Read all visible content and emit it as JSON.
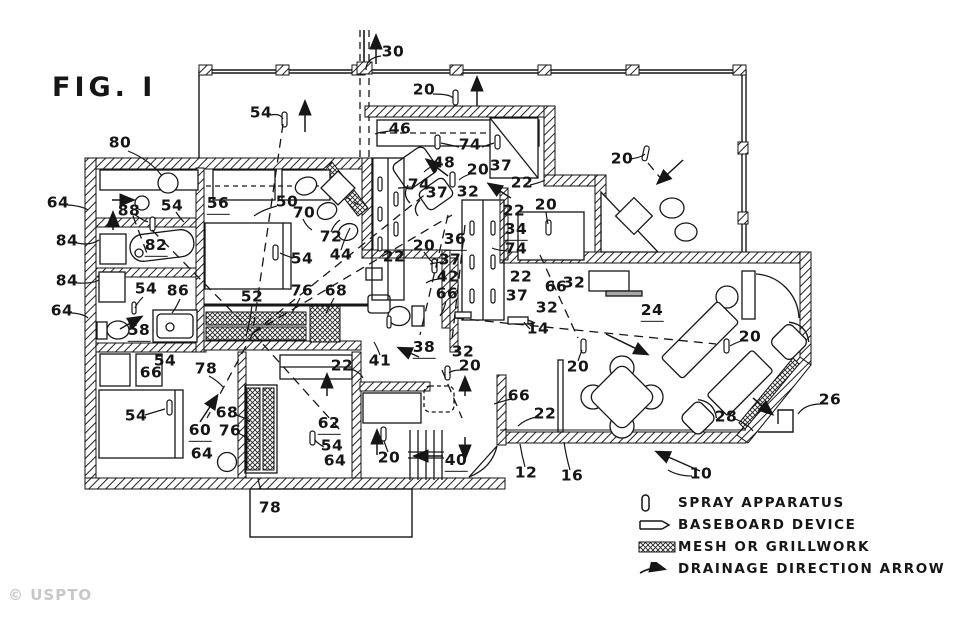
{
  "figure": {
    "title": "FIG. I"
  },
  "watermark": "© USPTO",
  "legend": {
    "items": [
      {
        "label": "SPRAY APPARATUS",
        "icon": "spray-apparatus-icon"
      },
      {
        "label": "BASEBOARD DEVICE",
        "icon": "baseboard-device-icon"
      },
      {
        "label": "MESH OR GRILLWORK",
        "icon": "mesh-grillwork-icon"
      },
      {
        "label": "DRAINAGE DIRECTION ARROW",
        "icon": "drainage-arrow-icon"
      }
    ]
  },
  "plan_labels": [
    {
      "t": "30",
      "x": 393,
      "y": 53
    },
    {
      "t": "54",
      "x": 261,
      "y": 114
    },
    {
      "t": "20",
      "x": 424,
      "y": 91
    },
    {
      "t": "20",
      "x": 622,
      "y": 160
    },
    {
      "t": "80",
      "x": 120,
      "y": 144
    },
    {
      "t": "46",
      "x": 400,
      "y": 130
    },
    {
      "t": "74",
      "x": 470,
      "y": 146
    },
    {
      "t": "48",
      "x": 444,
      "y": 164
    },
    {
      "t": "20",
      "x": 478,
      "y": 171
    },
    {
      "t": "37",
      "x": 501,
      "y": 167
    },
    {
      "t": "22",
      "x": 522,
      "y": 184
    },
    {
      "t": "74",
      "x": 419,
      "y": 186
    },
    {
      "t": "37",
      "x": 437,
      "y": 194
    },
    {
      "t": "32",
      "x": 468,
      "y": 193
    },
    {
      "t": "22",
      "x": 514,
      "y": 212
    },
    {
      "t": "20",
      "x": 546,
      "y": 206
    },
    {
      "t": "64",
      "x": 58,
      "y": 204
    },
    {
      "t": "88",
      "x": 129,
      "y": 212
    },
    {
      "t": "54",
      "x": 172,
      "y": 207
    },
    {
      "t": "56",
      "x": 218,
      "y": 206,
      "u": 1
    },
    {
      "t": "50",
      "x": 287,
      "y": 203
    },
    {
      "t": "70",
      "x": 304,
      "y": 214
    },
    {
      "t": "72",
      "x": 331,
      "y": 238
    },
    {
      "t": "44",
      "x": 341,
      "y": 256
    },
    {
      "t": "84",
      "x": 67,
      "y": 242
    },
    {
      "t": "82",
      "x": 156,
      "y": 248,
      "u": 1
    },
    {
      "t": "54",
      "x": 302,
      "y": 260
    },
    {
      "t": "22",
      "x": 394,
      "y": 258
    },
    {
      "t": "20",
      "x": 424,
      "y": 247
    },
    {
      "t": "36",
      "x": 455,
      "y": 242,
      "u": 1
    },
    {
      "t": "34",
      "x": 516,
      "y": 232,
      "u": 1
    },
    {
      "t": "74",
      "x": 516,
      "y": 250
    },
    {
      "t": "37",
      "x": 450,
      "y": 261
    },
    {
      "t": "42",
      "x": 448,
      "y": 278
    },
    {
      "t": "66",
      "x": 447,
      "y": 295
    },
    {
      "t": "22",
      "x": 521,
      "y": 278
    },
    {
      "t": "37",
      "x": 517,
      "y": 297
    },
    {
      "t": "66",
      "x": 556,
      "y": 288
    },
    {
      "t": "32",
      "x": 574,
      "y": 284
    },
    {
      "t": "84",
      "x": 67,
      "y": 282
    },
    {
      "t": "54",
      "x": 146,
      "y": 290
    },
    {
      "t": "86",
      "x": 178,
      "y": 292
    },
    {
      "t": "64",
      "x": 62,
      "y": 312
    },
    {
      "t": "52",
      "x": 252,
      "y": 298
    },
    {
      "t": "76",
      "x": 302,
      "y": 292
    },
    {
      "t": "68",
      "x": 336,
      "y": 292
    },
    {
      "t": "24",
      "x": 652,
      "y": 313,
      "u": 1
    },
    {
      "t": "20",
      "x": 750,
      "y": 338
    },
    {
      "t": "58",
      "x": 139,
      "y": 333,
      "u": 1
    },
    {
      "t": "54",
      "x": 165,
      "y": 362
    },
    {
      "t": "66",
      "x": 151,
      "y": 374
    },
    {
      "t": "78",
      "x": 206,
      "y": 370
    },
    {
      "t": "32",
      "x": 547,
      "y": 309
    },
    {
      "t": "14",
      "x": 538,
      "y": 330
    },
    {
      "t": "41",
      "x": 380,
      "y": 362
    },
    {
      "t": "38",
      "x": 424,
      "y": 350,
      "u": 1
    },
    {
      "t": "32",
      "x": 463,
      "y": 353
    },
    {
      "t": "20",
      "x": 470,
      "y": 367
    },
    {
      "t": "22",
      "x": 342,
      "y": 367
    },
    {
      "t": "20",
      "x": 578,
      "y": 368
    },
    {
      "t": "66",
      "x": 519,
      "y": 397
    },
    {
      "t": "22",
      "x": 545,
      "y": 415
    },
    {
      "t": "54",
      "x": 136,
      "y": 417
    },
    {
      "t": "68",
      "x": 227,
      "y": 414
    },
    {
      "t": "60",
      "x": 200,
      "y": 433,
      "u": 1
    },
    {
      "t": "76",
      "x": 230,
      "y": 432
    },
    {
      "t": "64",
      "x": 202,
      "y": 455
    },
    {
      "t": "62",
      "x": 329,
      "y": 426,
      "u": 1
    },
    {
      "t": "54",
      "x": 332,
      "y": 447
    },
    {
      "t": "64",
      "x": 335,
      "y": 462
    },
    {
      "t": "20",
      "x": 389,
      "y": 459
    },
    {
      "t": "40",
      "x": 456,
      "y": 463,
      "u": 1
    },
    {
      "t": "12",
      "x": 526,
      "y": 474
    },
    {
      "t": "16",
      "x": 572,
      "y": 477
    },
    {
      "t": "10",
      "x": 701,
      "y": 475
    },
    {
      "t": "28",
      "x": 726,
      "y": 418
    },
    {
      "t": "26",
      "x": 830,
      "y": 401
    },
    {
      "t": "78",
      "x": 270,
      "y": 509
    }
  ]
}
